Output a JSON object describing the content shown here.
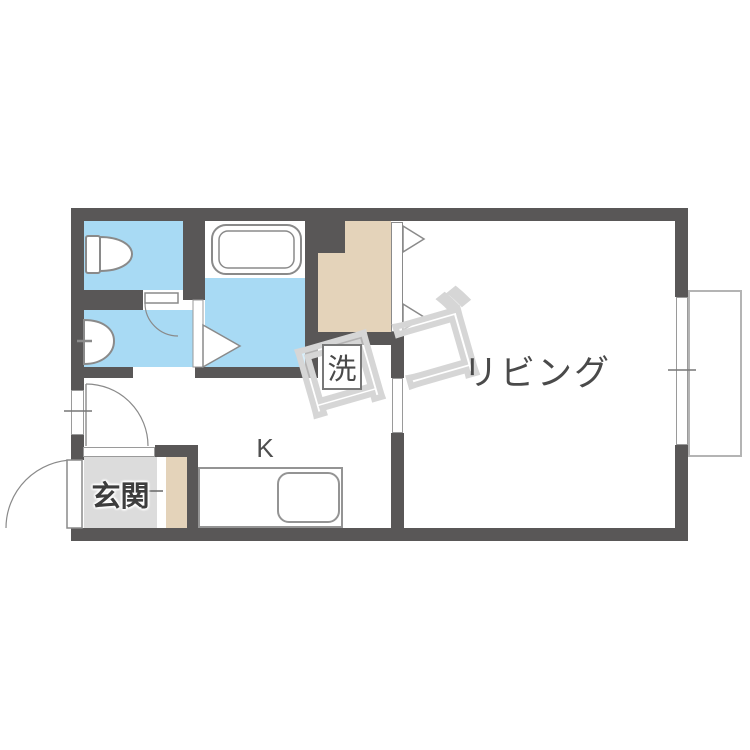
{
  "floor_plan": {
    "labels": {
      "living_room": "リビング",
      "entrance": "玄関",
      "kitchen": "K",
      "washing_machine": "洗"
    },
    "watermark": "ロゴ",
    "colors": {
      "wall": "#595757",
      "wet-area": "#a8daf4",
      "closet": "#e4d3ba",
      "entrance-floor": "#dcdcdc",
      "fixture-line": "#8a8a8a",
      "label-text": "#4a4a4a",
      "watermark-line": "#d6d6d6"
    },
    "features": {
      "rooms": [
        "living room",
        "kitchen",
        "entrance",
        "toilet",
        "washroom",
        "bathroom",
        "closet",
        "washer space",
        "balcony"
      ]
    }
  }
}
